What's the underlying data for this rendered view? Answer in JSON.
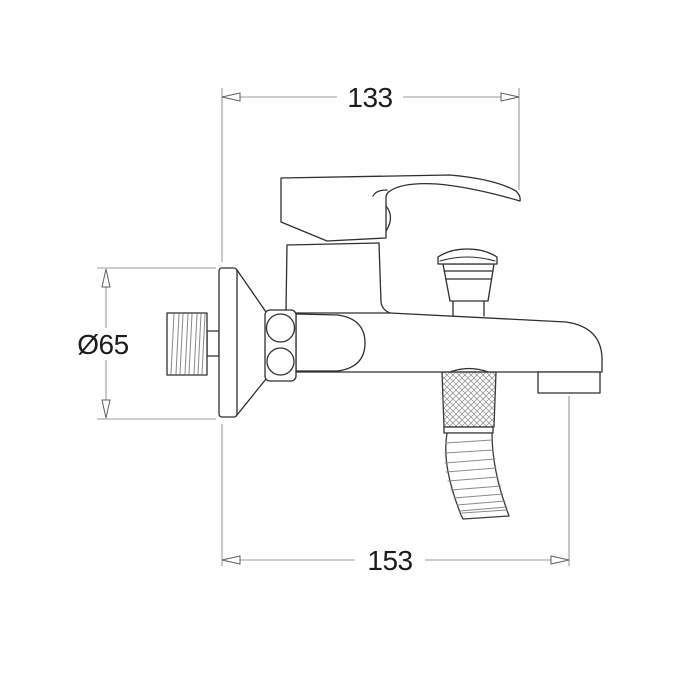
{
  "drawing": {
    "type": "technical-dimension-drawing",
    "subject": "wall-mounted single-lever bath shower mixer faucet, side view",
    "background_color": "#ffffff",
    "outline_color": "#2f2f2f",
    "detail_line_color": "#8a8a8a",
    "dimension_line_color": "#9b9b9b",
    "arrow_color": "#5f5f5f",
    "text_color": "#1c1c1c",
    "dimensions": {
      "top_width": {
        "label": "133",
        "orientation": "horizontal"
      },
      "bottom_reach": {
        "label": "153",
        "orientation": "horizontal"
      },
      "flange_diameter": {
        "label": "Ø65",
        "orientation": "vertical"
      }
    }
  }
}
